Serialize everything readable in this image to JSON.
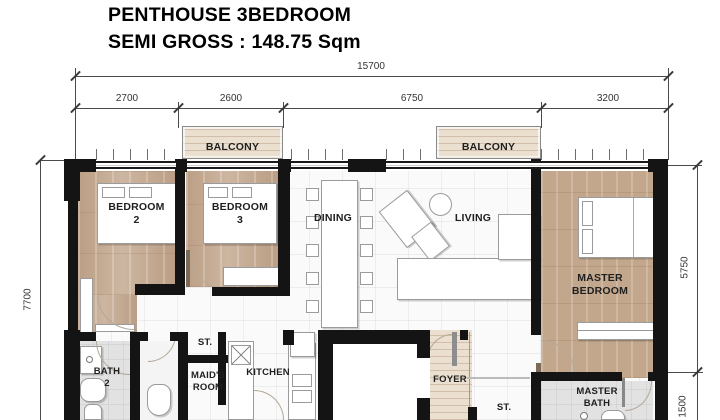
{
  "title": {
    "line1": "PENTHOUSE 3BEDROOM",
    "line2": "SEMI GROSS : 148.75 Sqm"
  },
  "dimensions": {
    "total_width": "15700",
    "segments": [
      "2700",
      "2600",
      "6750",
      "3200"
    ],
    "left_height": "7700",
    "right_top": "5750",
    "right_bottom": "1500"
  },
  "rooms": {
    "balcony_left": "BALCONY",
    "balcony_right": "BALCONY",
    "bedroom2": "BEDROOM\n2",
    "bedroom3": "BEDROOM\n3",
    "dining": "DINING",
    "living": "LIVING",
    "master_bedroom": "MASTER\nBEDROOM",
    "bath2": "BATH\n2",
    "storage_top": "ST.",
    "maids_room": "MAID'S\nROOM",
    "kitchen": "KITCHEN",
    "foyer": "FOYER",
    "storage_bottom": "ST.",
    "master_bath": "MASTER\nBATH"
  },
  "colors": {
    "wall": "#141414",
    "bedroom_wood": "#c6ac94",
    "master_wood": "#c2a78c",
    "balcony_wood": "#ebdfcf",
    "tile_floor": "#fafafa",
    "bath_floor": "#e2e2e2",
    "dimension_line": "#4a4a4a",
    "label_text": "#1f1f1f"
  }
}
